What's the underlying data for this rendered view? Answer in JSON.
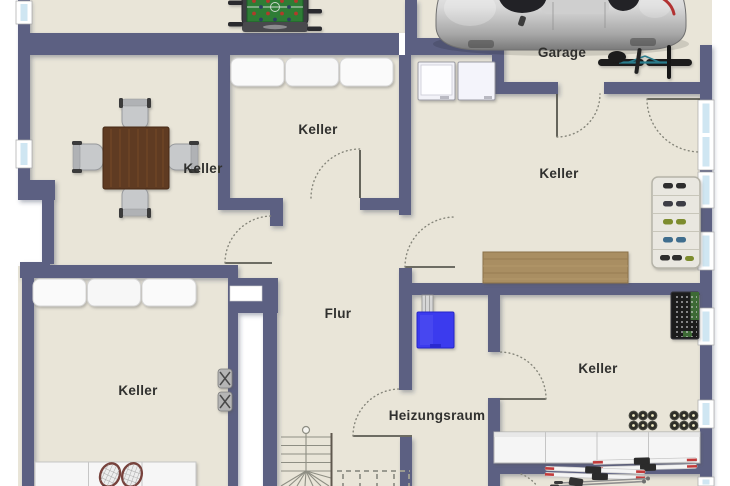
{
  "plan": {
    "type": "basement-floorplan",
    "rooms": [
      {
        "id": "garage",
        "label": "Garage"
      },
      {
        "id": "keller-top-left",
        "label": "Keller"
      },
      {
        "id": "keller-top-middle",
        "label": "Keller"
      },
      {
        "id": "keller-right",
        "label": "Keller"
      },
      {
        "id": "flur",
        "label": "Flur"
      },
      {
        "id": "keller-bottom-left",
        "label": "Keller"
      },
      {
        "id": "heizungsraum",
        "label": "Heizungsraum"
      },
      {
        "id": "keller-bottom-right",
        "label": "Keller"
      }
    ],
    "colors": {
      "wall": "#5b6182",
      "floor": "#e9e5d8",
      "outside": "#ffffff",
      "window_glass": "#cfe6f2",
      "boiler_blue": "#3b3bee",
      "workbench_wood": "#a98e62",
      "table_wood": "#5f3b20",
      "label_text": "#30302e"
    },
    "furniture": [
      {
        "name": "foosball-table"
      },
      {
        "name": "dining-table-with-chairs"
      },
      {
        "name": "storage-cushions-top"
      },
      {
        "name": "washing-machines"
      },
      {
        "name": "car"
      },
      {
        "name": "bicycle"
      },
      {
        "name": "shoe-rack"
      },
      {
        "name": "workbench"
      },
      {
        "name": "tool-pegboard"
      },
      {
        "name": "wine-bottle-racks"
      },
      {
        "name": "storage-cabinets"
      },
      {
        "name": "skis-and-poles"
      },
      {
        "name": "tennis-rackets"
      },
      {
        "name": "storage-cushions-bottom"
      },
      {
        "name": "storage-shelf-bottom"
      },
      {
        "name": "boiler"
      },
      {
        "name": "staircase"
      }
    ]
  }
}
